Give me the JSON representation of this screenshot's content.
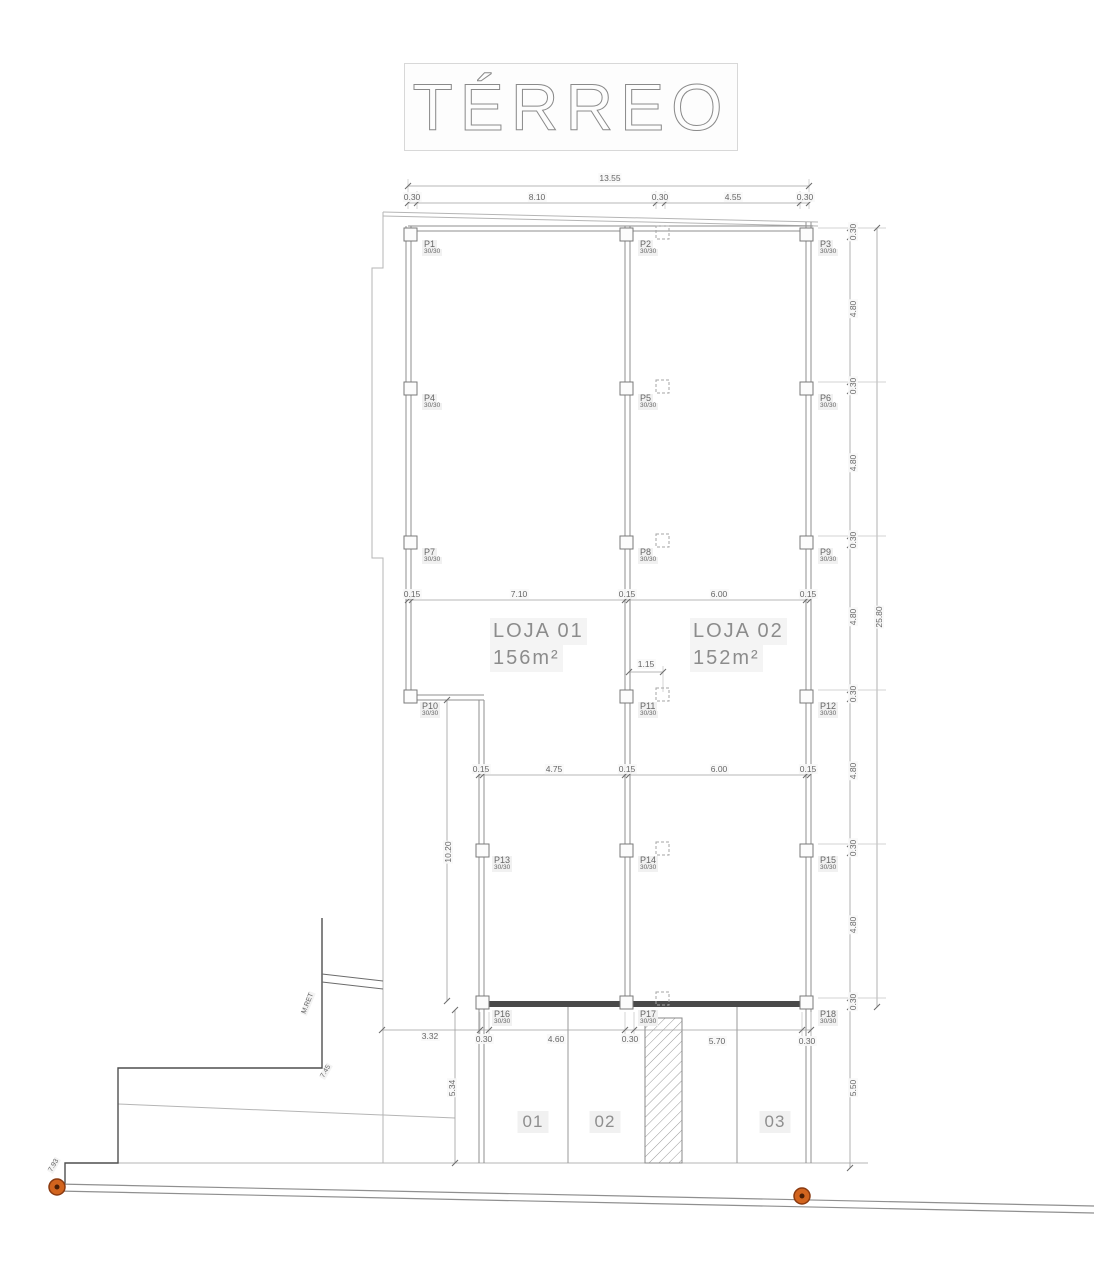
{
  "title": "TÉRREO",
  "shops": {
    "loja1": {
      "name": "LOJA  01",
      "area": "156m²"
    },
    "loja2": {
      "name": "LOJA  02",
      "area": "152m²"
    }
  },
  "stalls": [
    "01",
    "02",
    "03"
  ],
  "columns": [
    {
      "id": "P1",
      "size": "30/30"
    },
    {
      "id": "P2",
      "size": "30/30"
    },
    {
      "id": "P3",
      "size": "30/30"
    },
    {
      "id": "P4",
      "size": "30/30"
    },
    {
      "id": "P5",
      "size": "30/30"
    },
    {
      "id": "P6",
      "size": "30/30"
    },
    {
      "id": "P7",
      "size": "30/30"
    },
    {
      "id": "P8",
      "size": "30/30"
    },
    {
      "id": "P9",
      "size": "30/30"
    },
    {
      "id": "P10",
      "size": "30/30"
    },
    {
      "id": "P11",
      "size": "30/30"
    },
    {
      "id": "P12",
      "size": "30/30"
    },
    {
      "id": "P13",
      "size": "30/30"
    },
    {
      "id": "P14",
      "size": "30/30"
    },
    {
      "id": "P15",
      "size": "30/30"
    },
    {
      "id": "P16",
      "size": "30/30"
    },
    {
      "id": "P17",
      "size": "30/30"
    },
    {
      "id": "P18",
      "size": "30/30"
    }
  ],
  "dimensions": {
    "top": {
      "total": "13.55",
      "segments": [
        "0.30",
        "8.10",
        "0.30",
        "4.55",
        "0.30"
      ]
    },
    "row1": [
      "0.15",
      "7.10",
      "0.15",
      "6.00",
      "0.15"
    ],
    "row2": [
      "0.15",
      "4.75",
      "0.15",
      "6.00",
      "0.15"
    ],
    "gate": "1.15",
    "bottom": [
      "3.32",
      "0.30",
      "4.60",
      "0.30",
      "5.70",
      "0.30"
    ],
    "right": {
      "segments": [
        "0.30",
        "4.80",
        "0.30",
        "4.80",
        "0.30",
        "4.80",
        "0.30",
        "4.80",
        "0.30",
        "4.80",
        "0.30"
      ],
      "total": "25.80",
      "bottom": "5.50"
    },
    "left_vertical": [
      "10.20",
      "5.34"
    ]
  },
  "site": {
    "retaining_label": "M.RET",
    "spot_step": "7.45",
    "spot_curb": "7.93"
  },
  "colors": {
    "wall": "#8f8f8f",
    "dark": "#4a4a4a",
    "label": "#6a6a6a",
    "marker": "#d2641e"
  }
}
